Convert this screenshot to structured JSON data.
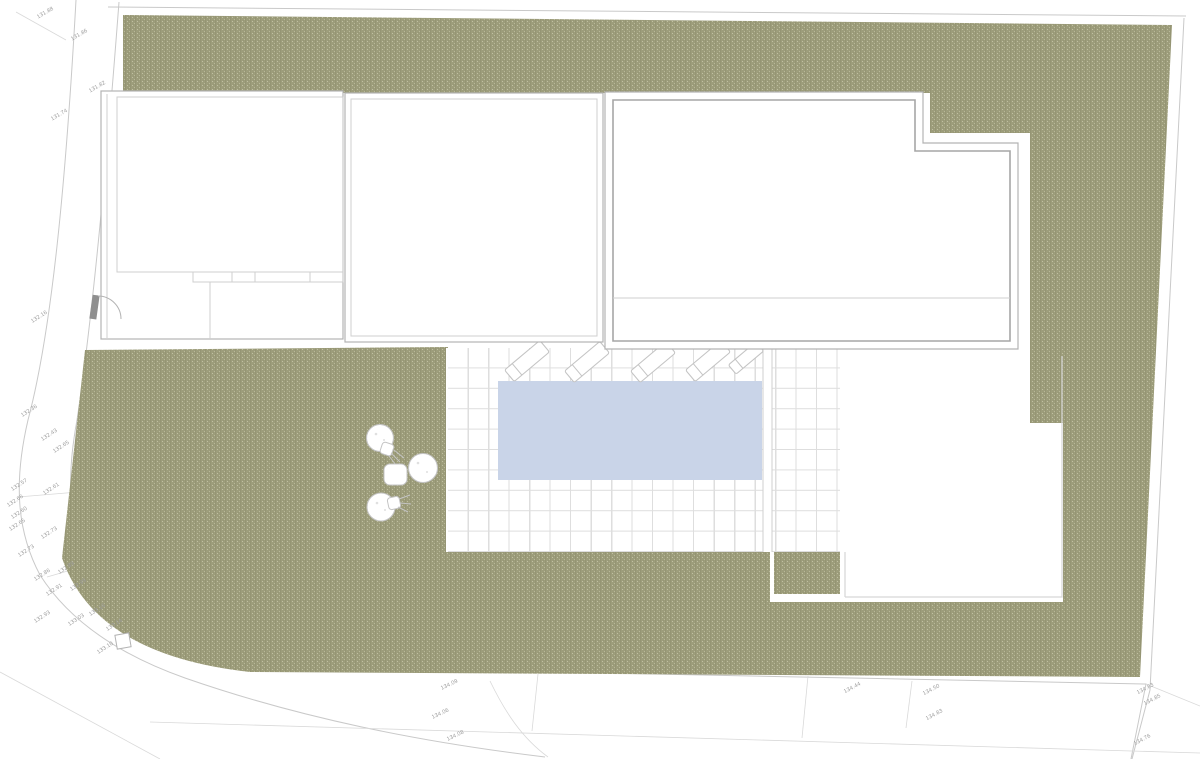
{
  "plan": {
    "kind": "residential-site-plan",
    "features": {
      "swimming_pool": "rectangular pool on tiled terrace",
      "buildings": 3,
      "sun_loungers": 5,
      "trees": 3,
      "garden_table": 1,
      "entrance_gate": 1,
      "utility_marker": 1
    }
  },
  "colors": {
    "landscape_green": "#9d9d7b",
    "green_dark": "#8c8c6b",
    "green_light": "#c9c9ab",
    "pool_blue": "#c9d4e8",
    "tile_line": "#dedede",
    "wall_line": "#b3b3b3",
    "wall_strong": "#a6a6a6",
    "wall_light": "#cfcfcf",
    "patio_line": "#d6d6d6",
    "boundary_line": "#c9c9c9",
    "boundary_faint": "#d9d9d9",
    "furniture_line": "#c4c4c4",
    "speckle": "#e0e0e0",
    "gate_post": "#8f8f8f",
    "label_gray": "#9c9c9c"
  },
  "elevation_labels": [
    {
      "text": "131.88",
      "x": 46,
      "y": 14,
      "rot": -30
    },
    {
      "text": "131.86",
      "x": 80,
      "y": 36,
      "rot": -30
    },
    {
      "text": "131.82",
      "x": 98,
      "y": 88,
      "rot": -30
    },
    {
      "text": "131.74",
      "x": 60,
      "y": 116,
      "rot": -30
    },
    {
      "text": "132.16",
      "x": 40,
      "y": 318,
      "rot": -33
    },
    {
      "text": "132.36",
      "x": 30,
      "y": 412,
      "rot": -33
    },
    {
      "text": "132.43",
      "x": 50,
      "y": 436,
      "rot": -33
    },
    {
      "text": "132.65",
      "x": 62,
      "y": 448,
      "rot": -33
    },
    {
      "text": "132.57",
      "x": 20,
      "y": 486,
      "rot": -33
    },
    {
      "text": "132.61",
      "x": 52,
      "y": 490,
      "rot": -33
    },
    {
      "text": "132.66",
      "x": 16,
      "y": 502,
      "rot": -33
    },
    {
      "text": "132.60",
      "x": 20,
      "y": 514,
      "rot": -33
    },
    {
      "text": "132.65",
      "x": 18,
      "y": 526,
      "rot": -33
    },
    {
      "text": "132.73",
      "x": 50,
      "y": 534,
      "rot": -33
    },
    {
      "text": "132.73",
      "x": 27,
      "y": 552,
      "rot": -33
    },
    {
      "text": "132.89",
      "x": 67,
      "y": 569,
      "rot": -33
    },
    {
      "text": "132.86",
      "x": 43,
      "y": 576,
      "rot": -33
    },
    {
      "text": "132.99",
      "x": 79,
      "y": 586,
      "rot": -33
    },
    {
      "text": "132.91",
      "x": 55,
      "y": 591,
      "rot": -33
    },
    {
      "text": "132.93",
      "x": 43,
      "y": 618,
      "rot": -33
    },
    {
      "text": "133.03",
      "x": 77,
      "y": 621,
      "rot": -33
    },
    {
      "text": "133.16",
      "x": 98,
      "y": 611,
      "rot": -33
    },
    {
      "text": "133.14",
      "x": 115,
      "y": 626,
      "rot": -33
    },
    {
      "text": "133.10",
      "x": 106,
      "y": 649,
      "rot": -33
    },
    {
      "text": "134.09",
      "x": 450,
      "y": 686,
      "rot": -25
    },
    {
      "text": "134.06",
      "x": 441,
      "y": 715,
      "rot": -25
    },
    {
      "text": "134.08",
      "x": 456,
      "y": 737,
      "rot": -25
    },
    {
      "text": "134.44",
      "x": 853,
      "y": 689,
      "rot": -28
    },
    {
      "text": "134.50",
      "x": 932,
      "y": 691,
      "rot": -28
    },
    {
      "text": "134.83",
      "x": 935,
      "y": 716,
      "rot": -28
    },
    {
      "text": "134.83",
      "x": 1146,
      "y": 690,
      "rot": -28
    },
    {
      "text": "134.85",
      "x": 1153,
      "y": 701,
      "rot": -28
    },
    {
      "text": "134.76",
      "x": 1143,
      "y": 741,
      "rot": -28
    }
  ]
}
